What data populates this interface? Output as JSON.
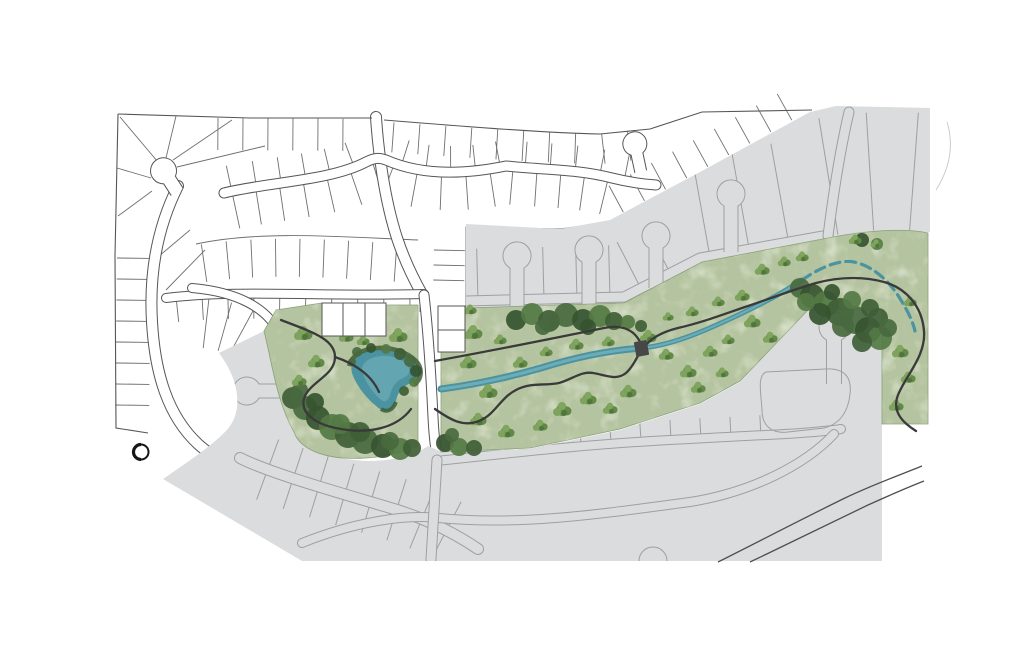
{
  "map": {
    "features": [
      {
        "name": "existing-residential-plat",
        "kind": "white lot linework with curvilinear streets and cul-de-sacs"
      },
      {
        "name": "future-phase-area",
        "kind": "gray shaded parcels with keyhole cul-de-sacs and roads"
      },
      {
        "name": "greenway-corridor",
        "kind": "watercolor park corridor"
      },
      {
        "name": "pond",
        "kind": "water body in west park"
      },
      {
        "name": "creek",
        "kind": "stream flowing east through corridor"
      },
      {
        "name": "walking-trails",
        "kind": "dark winding trail lines"
      },
      {
        "name": "footbridge",
        "kind": "trail crossing over creek"
      },
      {
        "name": "tree-clusters",
        "kind": "scattered canopy and dense forest stands"
      },
      {
        "name": "circle-marker",
        "kind": "small circular symbol at southwest edge"
      },
      {
        "name": "diagonal-road",
        "kind": "two-line road at southeast corner"
      }
    ]
  },
  "colors": {
    "white": "#ffffff",
    "platLine": "#565656",
    "platLot": "#6f6f6f",
    "grayFill": "#dbdcdd",
    "grayLine": "#9da0a1",
    "greenBase": "#b5c4a0",
    "greenEdge": "#8aa078",
    "treeMid": "#6f9750",
    "forestDark": "#3f5e36",
    "water": "#4b93a0",
    "waterLight": "#7cb8c0",
    "trail": "#3a3a3a",
    "bridge": "#474747",
    "roadDark": "#4f4f4f",
    "marker": "#161616",
    "faint": "#cccccc"
  }
}
